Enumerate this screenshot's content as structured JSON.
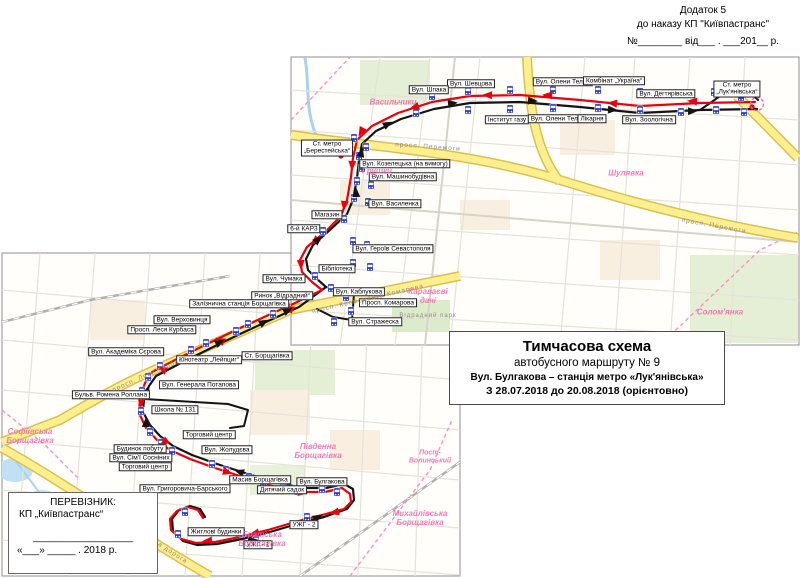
{
  "corner_note": {
    "line1": "Додаток 5",
    "line2": "до наказу КП \"Київпастранс\"",
    "line3": "№________ від___ . ___201__ р."
  },
  "title_box": {
    "line1": "Тимчасова схема",
    "line2": "автобусного маршруту № 9",
    "line3": "Вул. Булгакова – станція метро «Лук'янівська»",
    "line4": "З 28.07.2018 до 20.08.2018 (орієнтовно)"
  },
  "carrier_box": {
    "line1": "ПЕРЕВІЗНИК:",
    "line2": "КП „Київпастранс“",
    "signature_line": "__________________",
    "date_line": "«___» _____ . 2018 р."
  },
  "map": {
    "colors": {
      "route_red": "#e8000d",
      "route_black": "#141414",
      "stop_blue": "#2336cb",
      "area_pink": "#ef6fae",
      "road_yellow": "#ffef8f",
      "metro_red": "#e8000d",
      "terminal_pink": "#ff5fa2"
    },
    "stop_labels": [
      {
        "text": "Вул. Шевцова",
        "x": 471,
        "y": 84
      },
      {
        "text": "Вул. Олени Теліги",
        "x": 563,
        "y": 82
      },
      {
        "text": "Комбінат „Україна“",
        "x": 614,
        "y": 81
      },
      {
        "text": "Вул. Дегтярівська",
        "x": 666,
        "y": 94
      },
      {
        "text": "Ст. метро\n„Лук'янівська“",
        "x": 737,
        "y": 89
      },
      {
        "text": "Інститут газу",
        "x": 507,
        "y": 120
      },
      {
        "text": "Вул. Олени Теліги",
        "x": 558,
        "y": 119
      },
      {
        "text": "Лікарня",
        "x": 592,
        "y": 119
      },
      {
        "text": "Вул. Зоологічна",
        "x": 649,
        "y": 120
      },
      {
        "text": "Вул. Шпака",
        "x": 429,
        "y": 90
      },
      {
        "text": "Ст. метро\n„Берестейська“",
        "x": 327,
        "y": 148
      },
      {
        "text": "Вул. Козелецька (на вимогу)",
        "x": 405,
        "y": 164
      },
      {
        "text": "Вул. Машинобудівна",
        "x": 403,
        "y": 177
      },
      {
        "text": "Вул. Василенка",
        "x": 395,
        "y": 204
      },
      {
        "text": "Магазин",
        "x": 327,
        "y": 215
      },
      {
        "text": "6-й КАРЗ",
        "x": 304,
        "y": 229
      },
      {
        "text": "Вул. Героїв Севастополя",
        "x": 393,
        "y": 249
      },
      {
        "text": "Бібліотека",
        "x": 337,
        "y": 269
      },
      {
        "text": "Вул. Каблукова",
        "x": 359,
        "y": 292
      },
      {
        "text": "Просп. Комарова",
        "x": 388,
        "y": 303
      },
      {
        "text": "Вул. Стражеска",
        "x": 375,
        "y": 322
      },
      {
        "text": "Вул. Чумака",
        "x": 284,
        "y": 279
      },
      {
        "text": "Ринок „Відрадний“",
        "x": 282,
        "y": 296
      },
      {
        "text": "Залізнична станція Борщагівка",
        "x": 239,
        "y": 304
      },
      {
        "text": "Вул. Верховинця",
        "x": 182,
        "y": 320
      },
      {
        "text": "Просп. Леся Курбаса",
        "x": 162,
        "y": 330
      },
      {
        "text": "Вул. Академіка Сєрова",
        "x": 126,
        "y": 352
      },
      {
        "text": "Кінотеатр „Лейпциг“",
        "x": 209,
        "y": 360
      },
      {
        "text": "Ст. Борщагівка",
        "x": 267,
        "y": 356
      },
      {
        "text": "Вул. Генерала Потапова",
        "x": 199,
        "y": 385
      },
      {
        "text": "Бульв. Ромена Роллана",
        "x": 111,
        "y": 395
      },
      {
        "text": "Школа № 131",
        "x": 175,
        "y": 410
      },
      {
        "text": "Будинок побуту",
        "x": 140,
        "y": 449
      },
      {
        "text": "Вул. Сім'ї Сосніних",
        "x": 141,
        "y": 458
      },
      {
        "text": "Торговий центр",
        "x": 145,
        "y": 467
      },
      {
        "text": "Торговий центр",
        "x": 209,
        "y": 435
      },
      {
        "text": "Вул. Жолудєва",
        "x": 227,
        "y": 450
      },
      {
        "text": "Вул. Григоровича-Барського",
        "x": 185,
        "y": 489
      },
      {
        "text": "Житлові будинки",
        "x": 216,
        "y": 532
      },
      {
        "text": "Масив Борщагівка",
        "x": 260,
        "y": 480
      },
      {
        "text": "Дитячий садок",
        "x": 282,
        "y": 490
      },
      {
        "text": "Вул. Булгакова",
        "x": 322,
        "y": 482
      },
      {
        "text": "УЖГ - 2",
        "x": 304,
        "y": 525
      },
      {
        "text": "УЖГ - 1",
        "x": 258,
        "y": 545
      }
    ],
    "area_labels": [
      {
        "text": "Васильчики",
        "x": 393,
        "y": 103
      },
      {
        "text": "Грушки",
        "x": 377,
        "y": 172
      },
      {
        "text": "Шулявка",
        "x": 626,
        "y": 174
      },
      {
        "text": "Солом'янка",
        "x": 720,
        "y": 313
      },
      {
        "text": "Караваєві\nдачі",
        "x": 428,
        "y": 297
      },
      {
        "text": "Відрадний",
        "x": 476,
        "y": 368
      },
      {
        "text": "Пост-\nВолинський",
        "x": 430,
        "y": 457,
        "size": 7
      },
      {
        "text": "Михайлівська\nБорщагівка",
        "x": 420,
        "y": 519
      },
      {
        "text": "Братська\nБорщагівка",
        "x": 262,
        "y": 540
      },
      {
        "text": "Софіївська\nБорщагівка",
        "x": 30,
        "y": 437
      },
      {
        "text": "Південна\nБорщагівка",
        "x": 318,
        "y": 452
      }
    ],
    "road_labels": [
      {
        "text": "просп.  Перемоги",
        "x": 428,
        "y": 147,
        "rot": 4
      },
      {
        "text": "просп. Перемоги",
        "x": 714,
        "y": 226,
        "rot": 10
      },
      {
        "text": "просп. Космонавта  Комарова",
        "x": 368,
        "y": 299,
        "rot": -13
      },
      {
        "text": "просп.  Леся  Курбаса",
        "x": 150,
        "y": 374,
        "rot": -24
      },
      {
        "text": "Кільцева  дорога",
        "x": 160,
        "y": 545,
        "rot": 33
      },
      {
        "text": "Відрадний парк",
        "x": 428,
        "y": 316,
        "rot": 0,
        "size": 6
      }
    ],
    "routes": {
      "red": [
        [
          755,
          102
        ],
        [
          700,
          103
        ],
        [
          640,
          106
        ],
        [
          580,
          100
        ],
        [
          520,
          95
        ],
        [
          470,
          96
        ],
        [
          432,
          102
        ],
        [
          398,
          113
        ],
        [
          372,
          126
        ],
        [
          357,
          140
        ],
        [
          353,
          158
        ],
        [
          351,
          177
        ],
        [
          347,
          200
        ],
        [
          341,
          216
        ],
        [
          325,
          232
        ],
        [
          307,
          247
        ],
        [
          300,
          260
        ],
        [
          302,
          272
        ],
        [
          312,
          282
        ],
        [
          322,
          290
        ],
        [
          295,
          303
        ],
        [
          262,
          318
        ],
        [
          236,
          330
        ],
        [
          205,
          345
        ],
        [
          175,
          360
        ],
        [
          152,
          372
        ],
        [
          145,
          383
        ],
        [
          140,
          398
        ],
        [
          139,
          413
        ],
        [
          146,
          428
        ],
        [
          157,
          440
        ],
        [
          170,
          450
        ],
        [
          190,
          459
        ],
        [
          215,
          468
        ],
        [
          243,
          477
        ],
        [
          272,
          486
        ],
        [
          300,
          492
        ],
        [
          325,
          492
        ],
        [
          342,
          488
        ],
        [
          350,
          494
        ],
        [
          351,
          502
        ],
        [
          344,
          509
        ],
        [
          322,
          515
        ],
        [
          295,
          522
        ],
        [
          268,
          530
        ],
        [
          240,
          537
        ],
        [
          215,
          542
        ],
        [
          196,
          543
        ],
        [
          181,
          539
        ],
        [
          171,
          530
        ],
        [
          170,
          519
        ],
        [
          177,
          511
        ],
        [
          188,
          507
        ],
        [
          198,
          510
        ],
        [
          203,
          518
        ]
      ],
      "black": [
        [
          757,
          109
        ],
        [
          700,
          110
        ],
        [
          640,
          113
        ],
        [
          580,
          107
        ],
        [
          520,
          102
        ],
        [
          470,
          103
        ],
        [
          434,
          109
        ],
        [
          401,
          119
        ],
        [
          376,
          131
        ],
        [
          362,
          144
        ],
        [
          359,
          160
        ],
        [
          357,
          178
        ],
        [
          353,
          200
        ],
        [
          347,
          214
        ],
        [
          331,
          229
        ],
        [
          313,
          245
        ],
        [
          306,
          259
        ],
        [
          308,
          270
        ],
        [
          317,
          279
        ],
        [
          326,
          287
        ],
        [
          299,
          307
        ],
        [
          266,
          322
        ],
        [
          240,
          334
        ],
        [
          209,
          349
        ],
        [
          179,
          364
        ],
        [
          156,
          376
        ],
        [
          149,
          386
        ],
        [
          144,
          399
        ],
        [
          143,
          412
        ],
        [
          150,
          425
        ],
        [
          160,
          436
        ],
        [
          173,
          446
        ],
        [
          192,
          455
        ],
        [
          217,
          464
        ],
        [
          245,
          473
        ],
        [
          274,
          482
        ],
        [
          302,
          488
        ],
        [
          326,
          488
        ],
        [
          344,
          484
        ],
        [
          353,
          489
        ],
        [
          354,
          500
        ],
        [
          347,
          509
        ],
        [
          324,
          517
        ],
        [
          297,
          524
        ],
        [
          270,
          532
        ],
        [
          242,
          539
        ],
        [
          217,
          544
        ],
        [
          197,
          545
        ],
        [
          183,
          541
        ],
        [
          173,
          531
        ],
        [
          172,
          519
        ],
        [
          179,
          510
        ],
        [
          190,
          506
        ],
        [
          200,
          509
        ],
        [
          205,
          517
        ]
      ],
      "black_extra": [
        [
          [
            326,
            287
          ],
          [
            344,
            291
          ],
          [
            354,
            294
          ],
          [
            352,
            320
          ],
          [
            333,
            317
          ],
          [
            317,
            309
          ]
        ],
        [
          [
            700,
            110
          ],
          [
            726,
            92
          ],
          [
            748,
            90
          ],
          [
            758,
            100
          ]
        ],
        [
          [
            144,
            399
          ],
          [
            228,
            404
          ],
          [
            248,
            410
          ],
          [
            244,
            426
          ],
          [
            230,
            428
          ]
        ]
      ]
    },
    "arrows": {
      "red": [
        [
          690,
          101,
          185
        ],
        [
          610,
          103,
          185
        ],
        [
          545,
          95,
          183
        ],
        [
          485,
          95,
          182
        ],
        [
          412,
          108,
          162
        ],
        [
          360,
          134,
          118
        ],
        [
          352,
          168,
          93
        ],
        [
          344,
          208,
          97
        ],
        [
          313,
          243,
          137
        ],
        [
          301,
          267,
          88
        ],
        [
          287,
          307,
          208
        ],
        [
          218,
          339,
          208
        ],
        [
          160,
          368,
          207
        ],
        [
          141,
          405,
          94
        ],
        [
          162,
          444,
          142
        ],
        [
          230,
          473,
          17
        ],
        [
          305,
          493,
          8
        ],
        [
          332,
          513,
          167
        ],
        [
          252,
          534,
          167
        ],
        [
          205,
          541,
          176
        ]
      ],
      "black": [
        [
          255,
          540,
          -6
        ],
        [
          320,
          516,
          -30
        ],
        [
          300,
          486,
          184
        ],
        [
          237,
          471,
          198
        ],
        [
          146,
          420,
          -88
        ],
        [
          148,
          388,
          -75
        ],
        [
          222,
          341,
          -28
        ],
        [
          266,
          321,
          -28
        ],
        [
          290,
          309,
          -28
        ],
        [
          320,
          238,
          -42
        ],
        [
          356,
          190,
          -92
        ],
        [
          362,
          150,
          -75
        ],
        [
          390,
          123,
          -27
        ],
        [
          455,
          103,
          -6
        ],
        [
          535,
          101,
          3
        ],
        [
          615,
          110,
          3
        ],
        [
          695,
          111,
          -2
        ],
        [
          735,
          91,
          -18
        ]
      ]
    },
    "stops": [
      [
        468,
        91
      ],
      [
        510,
        90
      ],
      [
        553,
        90
      ],
      [
        598,
        90
      ],
      [
        640,
        92
      ],
      [
        681,
        94
      ],
      [
        468,
        110
      ],
      [
        510,
        109
      ],
      [
        553,
        108
      ],
      [
        598,
        108
      ],
      [
        640,
        110
      ],
      [
        681,
        112
      ],
      [
        714,
        92
      ],
      [
        716,
        110
      ],
      [
        741,
        97
      ],
      [
        744,
        112
      ],
      [
        432,
        96
      ],
      [
        416,
        113
      ],
      [
        354,
        138
      ],
      [
        366,
        147
      ],
      [
        359,
        156
      ],
      [
        362,
        168
      ],
      [
        357,
        181
      ],
      [
        371,
        185
      ],
      [
        354,
        198
      ],
      [
        368,
        202
      ],
      [
        344,
        219
      ],
      [
        323,
        231
      ],
      [
        353,
        241
      ],
      [
        367,
        245
      ],
      [
        353,
        263
      ],
      [
        370,
        267
      ],
      [
        331,
        288
      ],
      [
        346,
        297
      ],
      [
        351,
        311
      ],
      [
        334,
        322
      ],
      [
        315,
        276
      ],
      [
        287,
        307
      ],
      [
        273,
        314
      ],
      [
        248,
        324
      ],
      [
        236,
        331
      ],
      [
        206,
        343
      ],
      [
        191,
        350
      ],
      [
        160,
        366
      ],
      [
        148,
        377
      ],
      [
        142,
        391
      ],
      [
        141,
        411
      ],
      [
        150,
        432
      ],
      [
        161,
        443
      ],
      [
        172,
        451
      ],
      [
        212,
        464
      ],
      [
        226,
        470
      ],
      [
        249,
        477
      ],
      [
        263,
        483
      ],
      [
        283,
        487
      ],
      [
        297,
        491
      ],
      [
        322,
        489
      ],
      [
        337,
        492
      ],
      [
        307,
        517
      ],
      [
        242,
        533
      ],
      [
        256,
        540
      ],
      [
        185,
        512
      ],
      [
        178,
        534
      ]
    ],
    "metro_markers": [
      [
        341,
        156
      ],
      [
        752,
        107
      ]
    ],
    "terminal_dashed": [
      757,
      104
    ]
  }
}
